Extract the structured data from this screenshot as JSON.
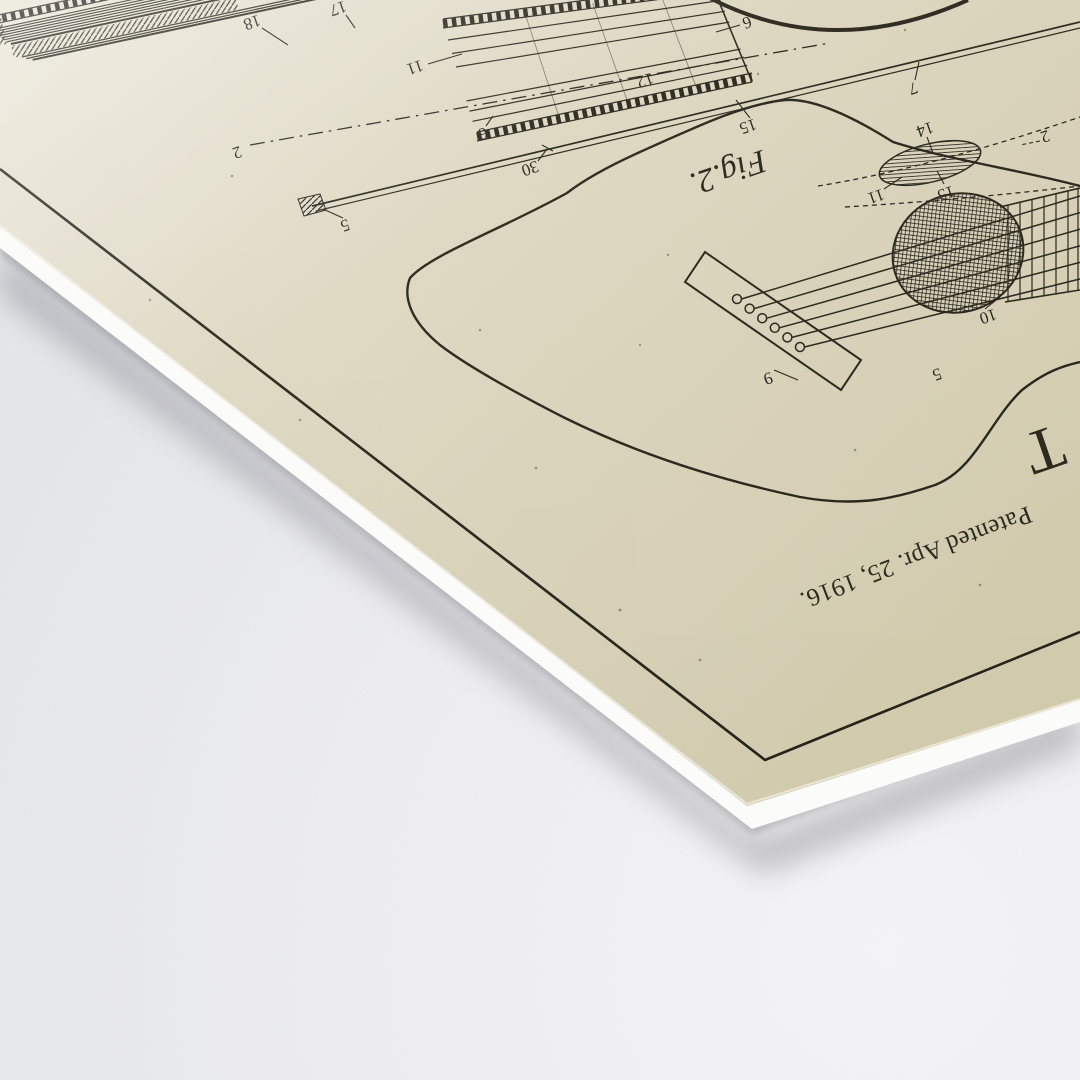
{
  "scene": {
    "background_color": "#edeef0",
    "paper_color": "#ddd7bf",
    "ink_color": "#262319",
    "undersheet_color": "#fbfbfa",
    "shadow_color": "#8e8e96"
  },
  "patent": {
    "header_date": "Patented Apr. 25, 1916.",
    "inventor_initial_partial": "T",
    "figure2_caption": "Fig.2.",
    "part_labels": [
      {
        "text": "18"
      },
      {
        "text": "17"
      },
      {
        "text": "11"
      },
      {
        "text": "12"
      },
      {
        "text": "6"
      },
      {
        "text": "15"
      },
      {
        "text": "6"
      },
      {
        "text": "30"
      },
      {
        "text": "5"
      },
      {
        "text": "2"
      },
      {
        "text": "7"
      },
      {
        "text": "14"
      },
      {
        "text": "15"
      },
      {
        "text": "11"
      },
      {
        "text": "2"
      },
      {
        "text": "10"
      },
      {
        "text": "9"
      },
      {
        "text": "5"
      }
    ]
  }
}
